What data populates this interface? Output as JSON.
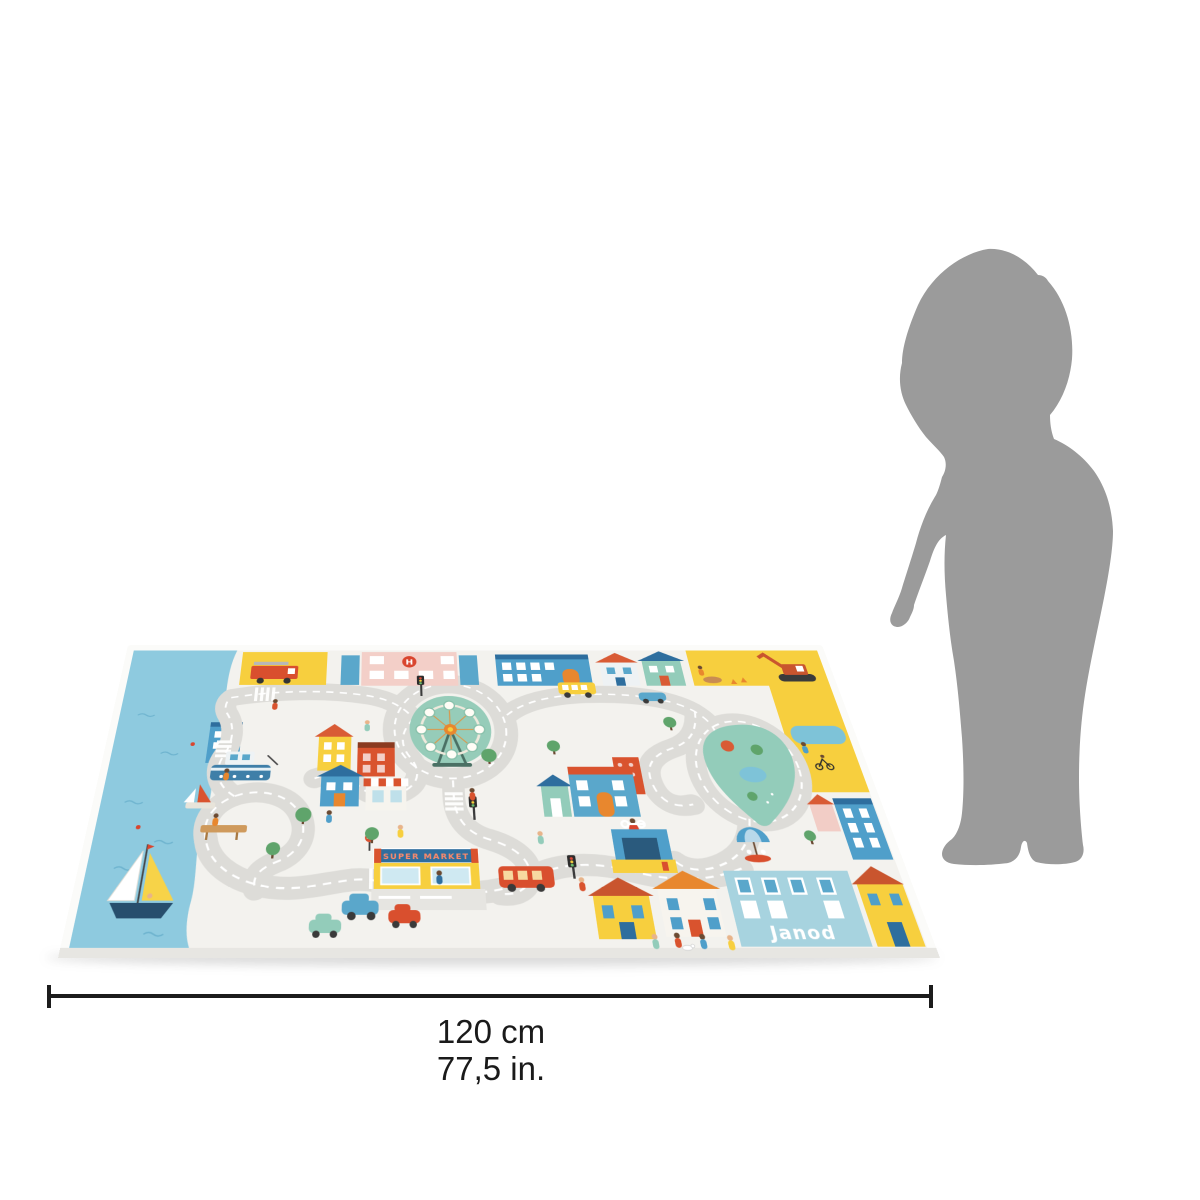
{
  "measurement": {
    "value_cm": "120 cm",
    "value_in": "77,5 in."
  },
  "mat": {
    "supermarket_sign": "SUPER MARKET",
    "brand": "Janod",
    "hospital_letter": "H",
    "colors": {
      "ground": "#f3f2ee",
      "road": "#dddcd8",
      "water": "#8ecadf",
      "yellow": "#f7cf3e",
      "red": "#d9532e",
      "blue": "#4f9fca",
      "navy": "#2e6e9e",
      "teal": "#93ccba",
      "pink": "#f3cfc8"
    }
  },
  "figure": {
    "icon": "child-silhouette-icon",
    "color": "#9b9b9b"
  }
}
